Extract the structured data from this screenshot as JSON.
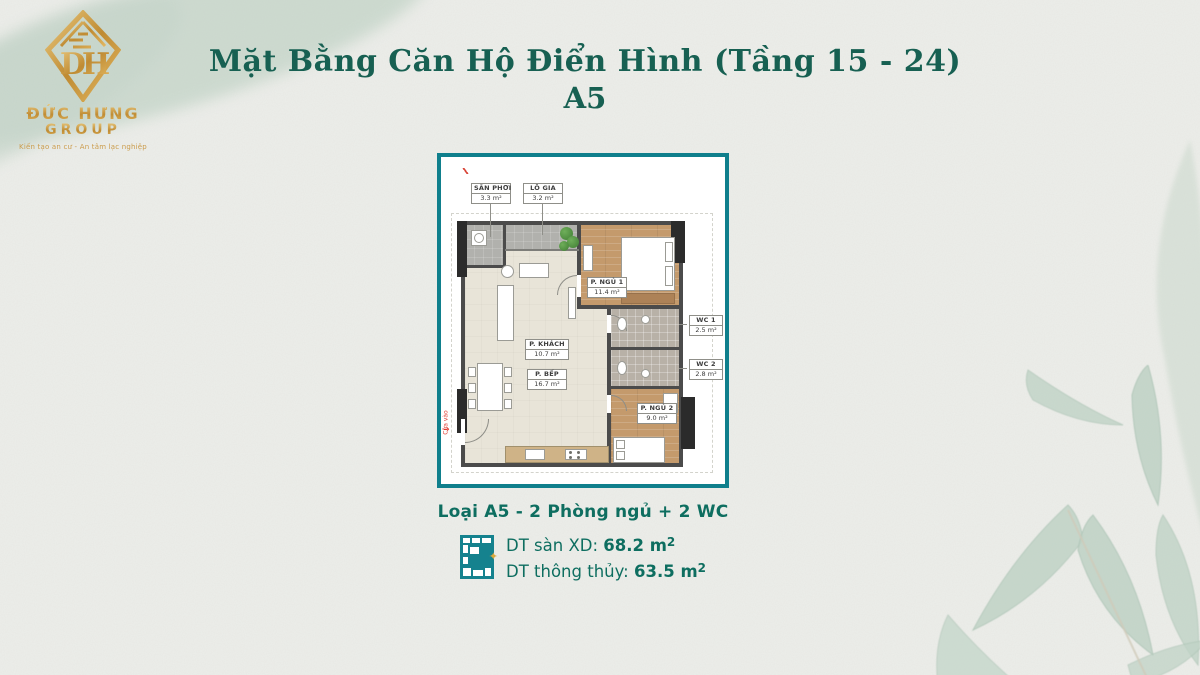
{
  "logo": {
    "monogram": "DH",
    "company": "ĐỨC HƯNG",
    "group": "GROUP",
    "tagline": "Kiến tạo an cư - An tâm lạc nghiệp"
  },
  "title": {
    "line1": "Mặt Bằng Căn Hộ Điển Hình (Tầng 15 - 24)",
    "line2": "A5"
  },
  "floor_plan": {
    "rooms": [
      {
        "name": "SÂN PHƠI",
        "area": "3.3 m²"
      },
      {
        "name": "LÔ GIA",
        "area": "3.2 m²"
      },
      {
        "name": "P. NGỦ 1",
        "area": "11.4 m²"
      },
      {
        "name": "P. KHÁCH",
        "area": "10.7 m²"
      },
      {
        "name": "P. BẾP",
        "area": "16.7 m²"
      },
      {
        "name": "WC 1",
        "area": "2.5 m²"
      },
      {
        "name": "WC 2",
        "area": "2.8 m²"
      },
      {
        "name": "P. NGỦ 2",
        "area": "9.0 m²"
      }
    ],
    "entry_label": "Cửa vào",
    "entry_arrow": "→"
  },
  "summary": {
    "type_label": "Loại A5 - 2 Phòng ngủ + 2 WC",
    "gross_label": "DT sàn XD: ",
    "gross_value": "68.2 m",
    "net_label": "DT thông thủy: ",
    "net_value": "63.5 m",
    "sup": "2",
    "spark": "✦"
  },
  "colors": {
    "accent_teal": "#0f7f8c",
    "text_green": "#0e6e60",
    "title_green": "#176052",
    "gold": "#c9973f",
    "wall": "#4b4b4b",
    "wood_floor": "#c49a6c",
    "entry_red": "#e0392e"
  }
}
